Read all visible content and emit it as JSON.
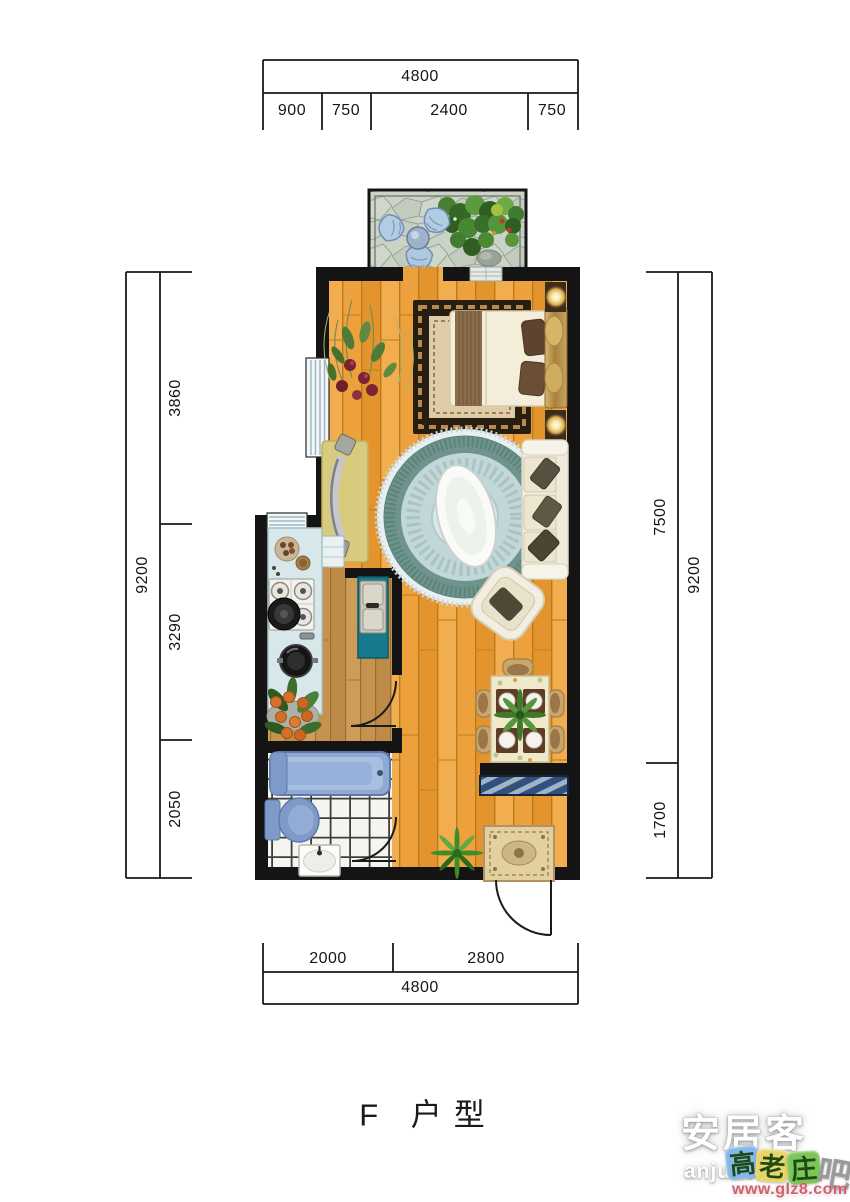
{
  "title": "F 户型",
  "dimensions": {
    "top": {
      "total": "4800",
      "segments": [
        "900",
        "750",
        "2400",
        "750"
      ]
    },
    "left": {
      "total": "9200",
      "segments": [
        "3860",
        "3290",
        "2050"
      ]
    },
    "right": {
      "total": "9200",
      "segments": [
        "7500",
        "1700"
      ]
    },
    "bottom": {
      "total": "4800",
      "segments": [
        "2000",
        "2800"
      ]
    }
  },
  "watermarks": {
    "anjuke": {
      "name": "安居客",
      "domain": "anjuke.com"
    },
    "glz8": {
      "chars": [
        "高",
        "老",
        "庄",
        "吧"
      ],
      "url": "www.glz8.com",
      "tile_colors": [
        "#85B8E8",
        "#E8D468",
        "#7CC658",
        "none"
      ],
      "url_color": "#D06070"
    }
  },
  "palette": {
    "wall": "#141414",
    "wood_floor": "#EDA13C",
    "kitchen_floor": "#C6934F",
    "bathroom_tile": "#F5F4EF",
    "balcony_paving": "#CBD3C7",
    "counter_blue": "#D8E7E9",
    "cabinet_teal": "#17798B",
    "tub_blue": "#8FA9D2",
    "round_rug_teal": "#6E948D",
    "bed_rug_border": "#281D11",
    "dimension_text": "#161616"
  }
}
